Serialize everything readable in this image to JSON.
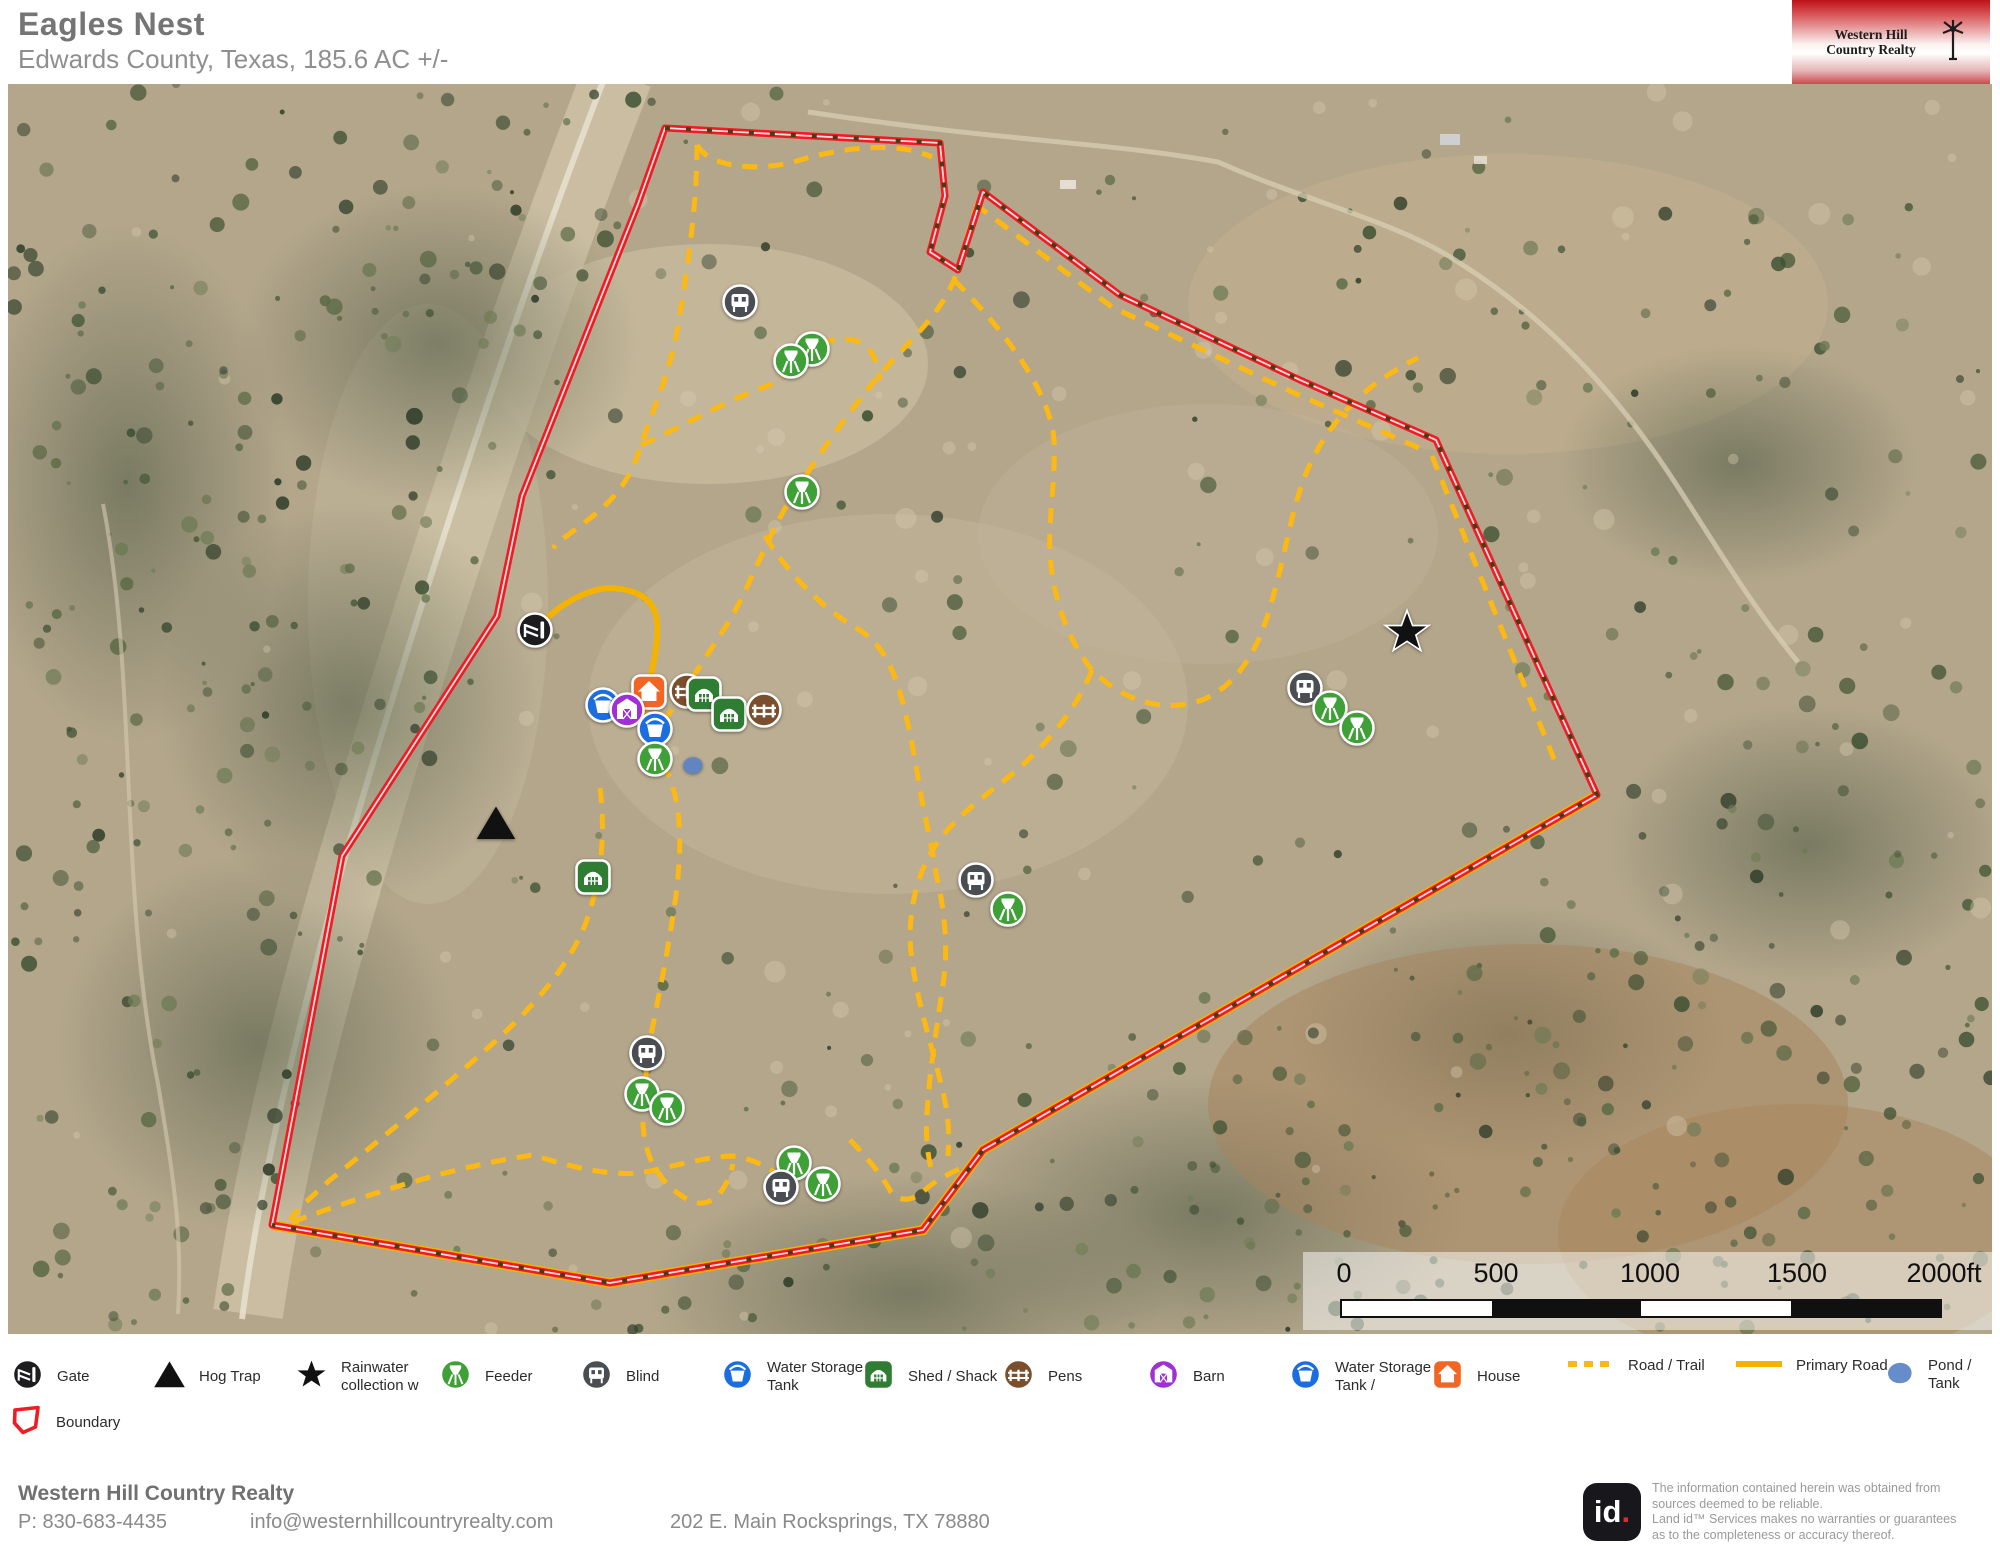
{
  "header": {
    "title": "Eagles Nest",
    "subtitle": "Edwards County, Texas, 185.6 AC +/-",
    "logo_text": "Western Hill Country Realty"
  },
  "scale_bar": {
    "labels": [
      "0",
      "500",
      "1000",
      "1500",
      "2000ft"
    ]
  },
  "legend": {
    "row1": [
      {
        "type": "gate",
        "label": "Gate",
        "x": 10
      },
      {
        "type": "hogtrap",
        "label": "Hog Trap",
        "x": 152
      },
      {
        "type": "star",
        "label": "Rainwater collection w",
        "x": 294
      },
      {
        "type": "feeder",
        "label": "Feeder",
        "x": 438
      },
      {
        "type": "blind",
        "label": "Blind",
        "x": 579
      },
      {
        "type": "tank",
        "label": "Water Storage Tank",
        "x": 720
      },
      {
        "type": "shed",
        "label": "Shed / Shack",
        "x": 861
      },
      {
        "type": "pens",
        "label": "Pens",
        "x": 1001
      },
      {
        "type": "barn",
        "label": "Barn",
        "x": 1146
      },
      {
        "type": "tank",
        "label": "Water Storage Tank /",
        "x": 1288
      },
      {
        "type": "house",
        "label": "House",
        "x": 1430
      },
      {
        "type": "road",
        "label": "Road / Trail",
        "x": 1566
      },
      {
        "type": "primary",
        "label": "Primary Road",
        "x": 1734
      },
      {
        "type": "pond",
        "label": "Pond / Tank",
        "x": 1884
      }
    ],
    "row2": [
      {
        "type": "boundary",
        "label": "Boundary",
        "x": 10
      }
    ]
  },
  "map": {
    "markers": [
      {
        "type": "blind",
        "x": 732,
        "y": 218
      },
      {
        "type": "feeder",
        "x": 804,
        "y": 265
      },
      {
        "type": "feeder",
        "x": 783,
        "y": 277
      },
      {
        "type": "feeder",
        "x": 794,
        "y": 408
      },
      {
        "type": "gate",
        "x": 527,
        "y": 546
      },
      {
        "type": "hogtrap",
        "x": 488,
        "y": 739
      },
      {
        "type": "star",
        "x": 1399,
        "y": 548
      },
      {
        "type": "blind",
        "x": 1297,
        "y": 604
      },
      {
        "type": "feeder",
        "x": 1322,
        "y": 624
      },
      {
        "type": "feeder",
        "x": 1349,
        "y": 644
      },
      {
        "type": "blind",
        "x": 968,
        "y": 796
      },
      {
        "type": "feeder",
        "x": 1000,
        "y": 825
      },
      {
        "type": "shed",
        "x": 585,
        "y": 793
      },
      {
        "type": "blind",
        "x": 639,
        "y": 969
      },
      {
        "type": "feeder",
        "x": 634,
        "y": 1010
      },
      {
        "type": "feeder",
        "x": 659,
        "y": 1024
      },
      {
        "type": "feeder",
        "x": 786,
        "y": 1079
      },
      {
        "type": "blind",
        "x": 773,
        "y": 1103
      },
      {
        "type": "feeder",
        "x": 815,
        "y": 1100
      },
      {
        "type": "pond",
        "x": 685,
        "y": 681
      },
      {
        "type": "house",
        "x": 641,
        "y": 608
      },
      {
        "type": "pens",
        "x": 679,
        "y": 607
      },
      {
        "type": "shed",
        "x": 696,
        "y": 610
      },
      {
        "type": "shed",
        "x": 721,
        "y": 630
      },
      {
        "type": "pens",
        "x": 756,
        "y": 626
      },
      {
        "type": "tank",
        "x": 595,
        "y": 621
      },
      {
        "type": "barn",
        "x": 619,
        "y": 626
      },
      {
        "type": "tank",
        "x": 647,
        "y": 645
      },
      {
        "type": "feeder",
        "x": 647,
        "y": 675
      }
    ]
  },
  "footer": {
    "company": "Western Hill Country Realty",
    "phone": "P: 830-683-4435",
    "email": "info@westernhillcountryrealty.com",
    "address": "202 E. Main Rocksprings, TX 78880",
    "badge": "id."
  },
  "disclaimer": {
    "lines": [
      "The information contained herein was obtained from",
      "sources deemed to be reliable.",
      "  Land id™ Services makes no warranties or guarantees",
      "as to the completeness or accuracy thereof."
    ]
  },
  "colors": {
    "boundary": "#ee1c24",
    "trail": "#fdb913",
    "primary_road": "#f3b300",
    "gate": "#1d1d1f",
    "hog_trap": "#111111",
    "rainwater_star": "#111111",
    "feeder": "#3fa037",
    "blind": "#4a4d52",
    "water_tank": "#1a6ee0",
    "shed": "#2e7d32",
    "pens": "#7b4f2e",
    "barn": "#a02fd6",
    "house": "#f26522",
    "pond": "#5f86c7"
  }
}
